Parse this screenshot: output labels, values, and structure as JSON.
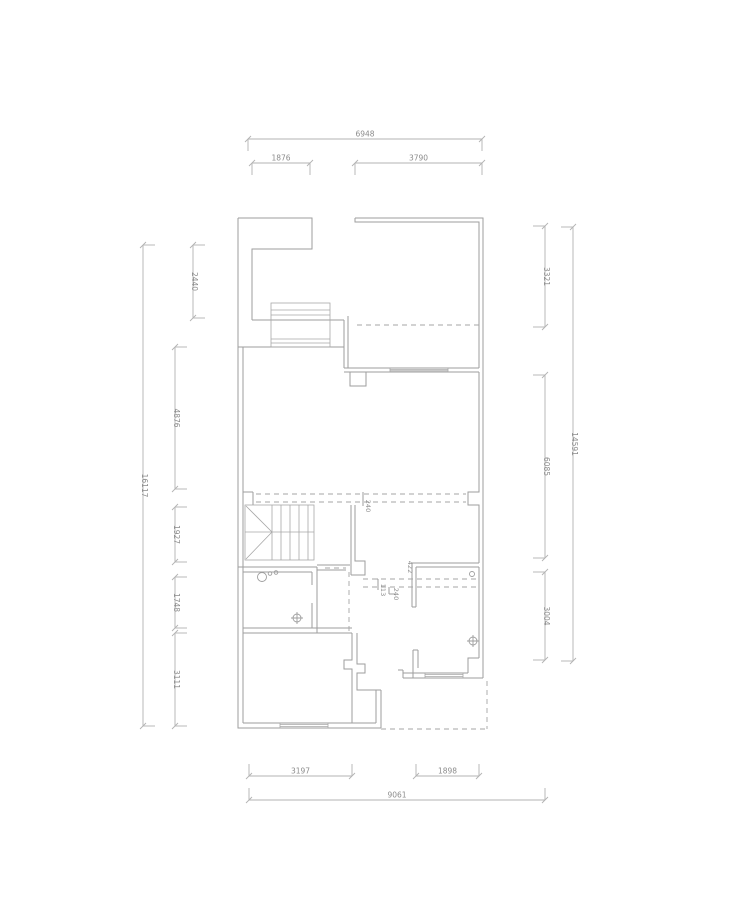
{
  "drawing": {
    "type": "architectural-floor-plan",
    "colors": {
      "wall": "#9e9e9e",
      "dimension": "#b3b3b3",
      "text": "#8c8c8c",
      "background": "#ffffff"
    },
    "dimension_summary": {
      "top": {
        "overall": "6948",
        "segments": [
          "1876",
          "3790"
        ]
      },
      "left": {
        "overall": "16117",
        "segments": [
          "2440",
          "4876",
          "1927",
          "1748",
          "3111"
        ]
      },
      "right": {
        "overall": "14591",
        "segments": [
          "3321",
          "6085",
          "3004"
        ]
      },
      "bottom": {
        "overall": "9061",
        "segments": [
          "3197",
          "1898"
        ]
      },
      "interior": [
        "240",
        "422",
        "113",
        "240"
      ]
    },
    "dimensions": [
      {
        "value": "6948",
        "orient": "h",
        "x1": 248,
        "x2": 482,
        "y": 139,
        "hook": 1
      },
      {
        "value": "1876",
        "orient": "h",
        "x1": 252,
        "x2": 310,
        "y": 163,
        "hook": 1
      },
      {
        "value": "3790",
        "orient": "h",
        "x1": 355,
        "x2": 482,
        "y": 163,
        "hook": 1
      },
      {
        "value": "16117",
        "orient": "v",
        "y1": 245,
        "y2": 726,
        "x": 143,
        "hook": 1
      },
      {
        "value": "2440",
        "orient": "v",
        "y1": 245,
        "y2": 318,
        "x": 193,
        "hook": 1
      },
      {
        "value": "4876",
        "orient": "v",
        "y1": 347,
        "y2": 489,
        "x": 175,
        "hook": 1
      },
      {
        "value": "1927",
        "orient": "v",
        "y1": 507,
        "y2": 562,
        "x": 175,
        "hook": 1
      },
      {
        "value": "1748",
        "orient": "v",
        "y1": 577,
        "y2": 628,
        "x": 175,
        "hook": 1
      },
      {
        "value": "3111",
        "orient": "v",
        "y1": 633,
        "y2": 726,
        "x": 175,
        "hook": 1
      },
      {
        "value": "3321",
        "orient": "v",
        "y1": 226,
        "y2": 327,
        "x": 545,
        "hook": -1
      },
      {
        "value": "6085",
        "orient": "v",
        "y1": 375,
        "y2": 558,
        "x": 545,
        "hook": -1
      },
      {
        "value": "3004",
        "orient": "v",
        "y1": 572,
        "y2": 660,
        "x": 545,
        "hook": -1
      },
      {
        "value": "14591",
        "orient": "v",
        "y1": 227,
        "y2": 661,
        "x": 573,
        "hook": -1
      },
      {
        "value": "3197",
        "orient": "h",
        "x1": 249,
        "x2": 352,
        "y": 776,
        "hook": -1
      },
      {
        "value": "1898",
        "orient": "h",
        "x1": 416,
        "x2": 479,
        "y": 776,
        "hook": -1
      },
      {
        "value": "9061",
        "orient": "h",
        "x1": 249,
        "x2": 545,
        "y": 800,
        "hook": -1
      }
    ],
    "interior_labels": [
      {
        "value": "240",
        "x": 366,
        "y": 506
      },
      {
        "value": "422",
        "x": 408,
        "y": 567
      },
      {
        "value": "113",
        "x": 381,
        "y": 590
      },
      {
        "value": "240",
        "x": 394,
        "y": 594
      }
    ]
  }
}
